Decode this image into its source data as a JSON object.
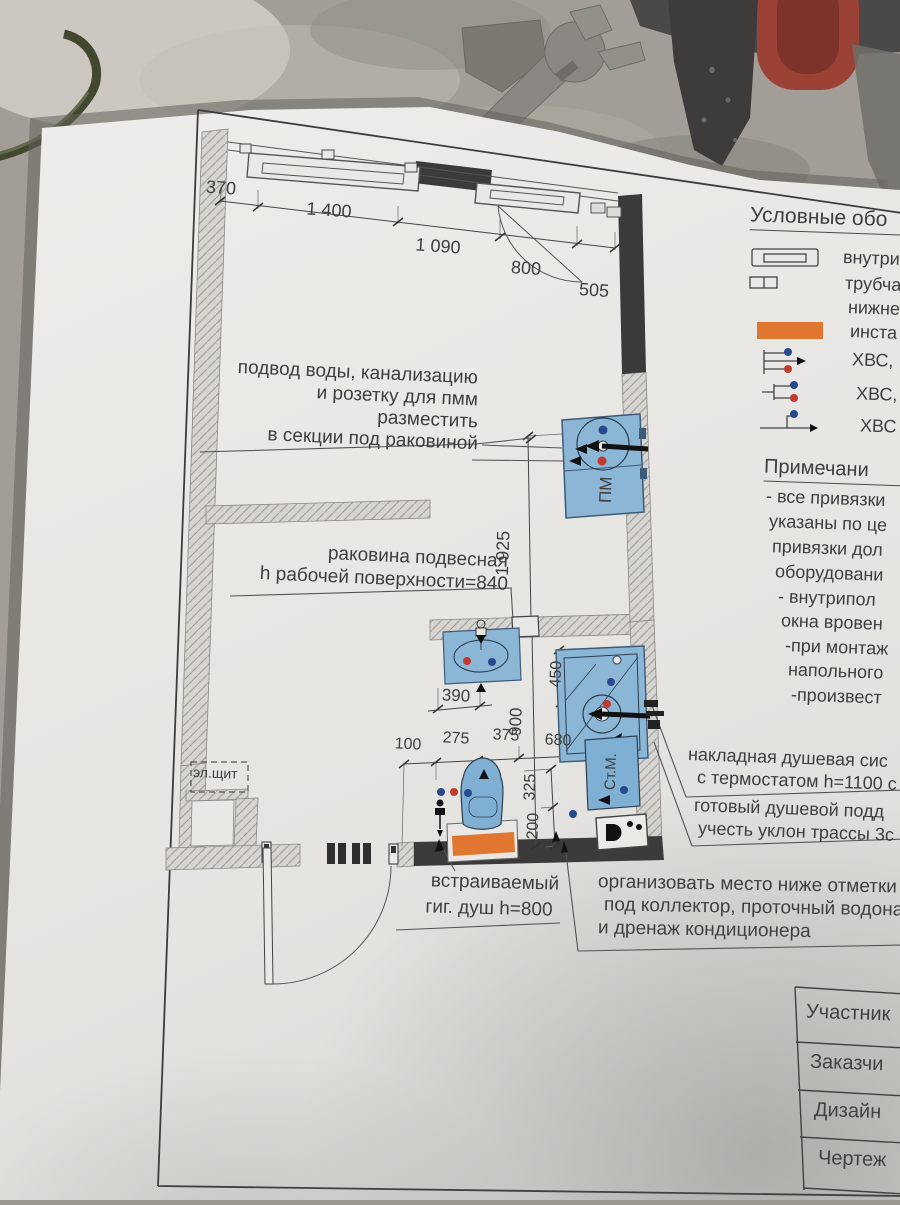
{
  "colors": {
    "paper": "#e9e8e5",
    "line": "#3f3f3f",
    "wall_dark": "#3a3a3a",
    "fixture_blue": "#8cb6d6",
    "dot_blue": "#274a8e",
    "dot_red": "#c23a2c",
    "installation_orange": "#e0762f"
  },
  "plan": {
    "dims_top": [
      "370",
      "1 400",
      "1 090",
      "800",
      "505"
    ],
    "dim_depth": "1 925",
    "dim_bath_width": "900",
    "dim_sink": "390",
    "dim_shower": "450",
    "dims_wc": [
      "100",
      "275",
      "375",
      "680"
    ],
    "dim_325": "325",
    "dim_200": "200",
    "label_elshield": "эл.щит",
    "label_dishwasher": "ПМ",
    "label_washer": "Ст.М."
  },
  "callouts": {
    "sink_cabinet": [
      "подвод воды, канализацию",
      "и розетку для пмм",
      "разместить",
      "в секции под раковиной"
    ],
    "basin": [
      "раковина подвесная",
      "h  рабочей поверхности=840"
    ],
    "shower_system": [
      "накладная душевая сис",
      "с термостатом h=1100 с"
    ],
    "shower_tray": [
      "готовый душевой подд",
      "учесть уклон трассы 3с"
    ],
    "hyg_shower": [
      "встраиваемый",
      "гиг. душ h=800"
    ],
    "collector": [
      "организовать место ниже отметки h",
      "под коллектор, проточный водона",
      "и дренаж кондиционера"
    ]
  },
  "legend": {
    "title": "Условные обо",
    "items": [
      {
        "icon": "convector-icon",
        "label": "внутри"
      },
      {
        "icon": "radiator-icon",
        "label": "трубча",
        "label2": "нижне"
      },
      {
        "icon": "installation-icon",
        "label": "инста"
      },
      {
        "icon": "water-supply-icon",
        "label": "ХВС,"
      },
      {
        "icon": "water-supply-icon",
        "label": "ХВС,"
      },
      {
        "icon": "water-outlet-icon",
        "label": "ХВС"
      }
    ]
  },
  "notes": {
    "title": "Примечани",
    "lines": [
      "- все привязки",
      "указаны по це",
      "привязки дол",
      "оборудовани",
      "- внутрипол",
      "окна вровен",
      "-при монтаж",
      "напольного",
      "-произвест"
    ]
  },
  "titleblock": {
    "rows": [
      "Участник",
      "Заказчи",
      "Дизайн",
      "Чертеж"
    ]
  }
}
